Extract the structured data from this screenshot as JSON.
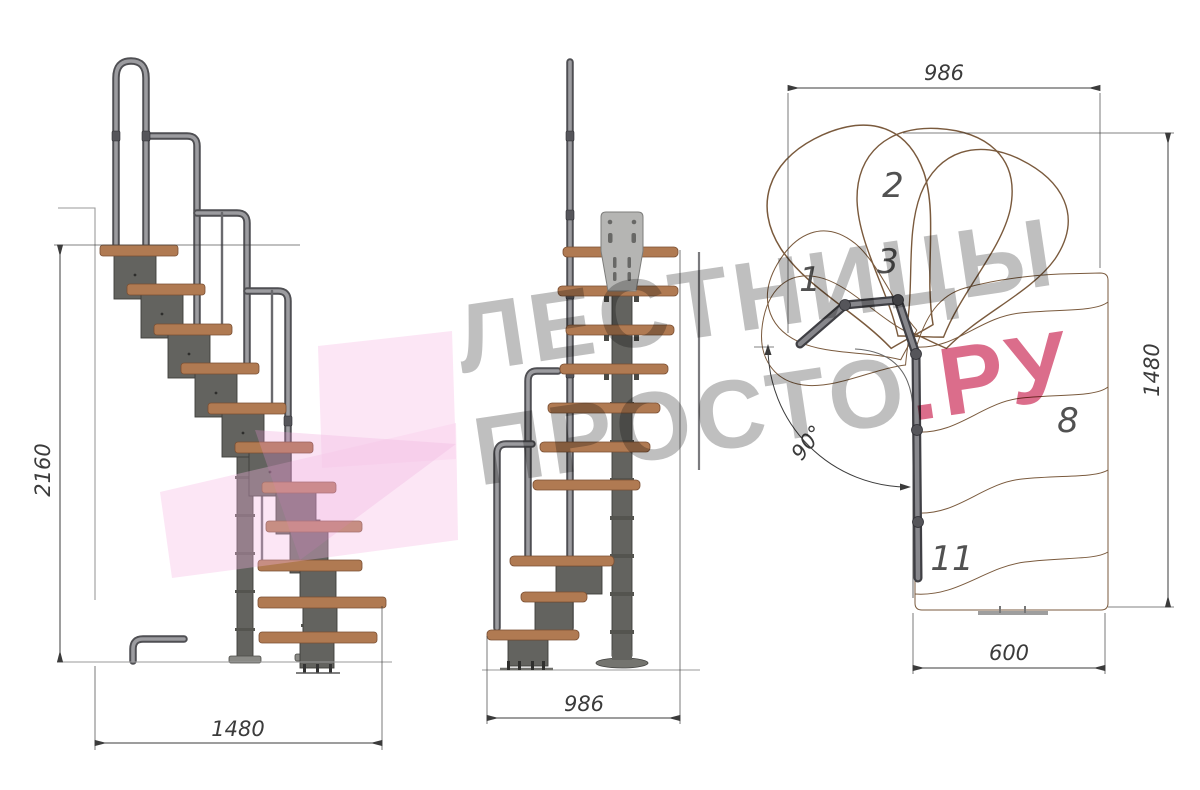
{
  "drawing": {
    "type": "staircase-technical-drawing",
    "views": {
      "side": {
        "height_dim": "2160",
        "width_dim": "1480"
      },
      "front": {
        "width_dim": "986"
      },
      "plan": {
        "top_dim": "986",
        "right_dim": "1480",
        "bottom_dim": "600",
        "angle_dim": "90°",
        "tread_labels": [
          "1",
          "2",
          "3",
          "8",
          "11"
        ]
      }
    }
  },
  "watermark": {
    "line1": "ЛЕСТНИЦЫ",
    "line2": "ПРОСТО",
    "suffix": ".РУ"
  },
  "colors": {
    "wood": "#c49a72",
    "wood_grain": "#8d6847",
    "wood_side": "#b07a52",
    "metal": "#63635f",
    "metal_dark": "#3d3d3b",
    "rail": "#9c9ca0",
    "rail_dark": "#4f4f53",
    "plate": "#b5b5b3",
    "dim": "#3b3b3b",
    "logo_pink": "#f5b5e2",
    "watermark_pink": "#cd345e"
  }
}
